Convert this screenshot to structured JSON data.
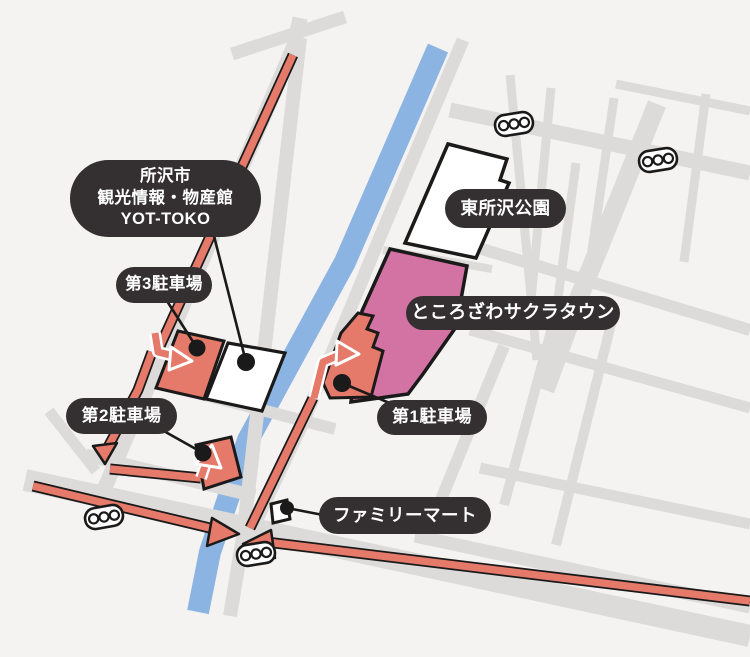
{
  "colors": {
    "background": "#F4F3F1",
    "road": "#DCDBD9",
    "river": "#8CB4E2",
    "route": "#E5796A",
    "parking": "#E5796A",
    "sakura_town": "#D373A3",
    "building": "#FFFFFF",
    "outline": "#1A1A1A",
    "label_bg": "#343031",
    "label_text": "#FFFFFF"
  },
  "labels": {
    "yot_toko": {
      "text": "所沢市\n観光情報・物産館\nYOT-TOKO"
    },
    "parking3": {
      "text": "第3駐車場"
    },
    "parking2": {
      "text": "第2駐車場"
    },
    "park": {
      "text": "東所沢公園"
    },
    "sakura_town": {
      "text": "ところざわサクラタウン"
    },
    "parking1": {
      "text": "第1駐車場"
    },
    "familymart": {
      "text": "ファミリーマート"
    }
  },
  "icons": {
    "traffic_signal": {
      "name": "traffic-signal-icon",
      "count": 4
    }
  }
}
